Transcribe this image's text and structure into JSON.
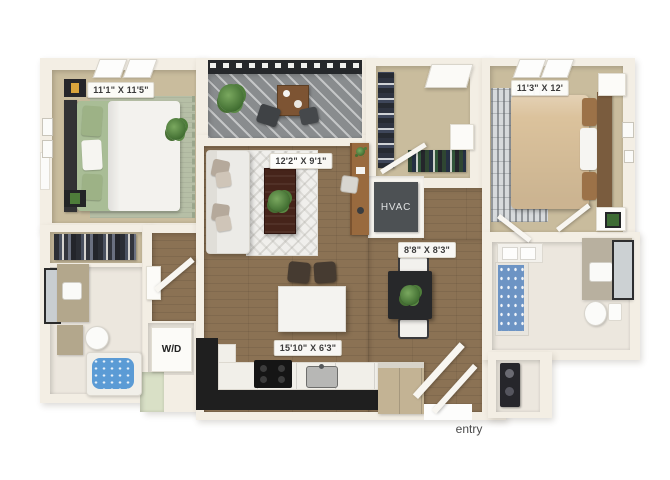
{
  "image_type": "3d-apartment-floor-plan-render",
  "labels": {
    "bedroom_left": "11'1\" X 11'5\"",
    "living_room": "12'2\" X 9'1\"",
    "bedroom_right": "11'3\" X 12'",
    "dining_area": "8'8\" X 8'3\"",
    "kitchen": "15'10\" X 6'3\"",
    "hvac": "HVAC",
    "washer_dryer": "W/D",
    "entry": "entry"
  },
  "colors": {
    "background": "#ffffff",
    "wall": "#f3eee4",
    "carpet": "#c9bc9d",
    "wood_floor": "#8b7254",
    "bath_tile": "#ece7de",
    "balcony_deck": "#898c8e",
    "railing_dark": "#26282b",
    "hvac_box": "#4d5154",
    "kitchen_counter_black": "#1f1f1f",
    "cabinet_tan": "#c3b394",
    "bed_green": "#a9bd96",
    "bed_tan": "#dbc29c",
    "tub_water_blue": "#5b9bd5",
    "shower_curtain_blue": "#6d94c4",
    "plant_green": "#4e7d3a",
    "label_text": "#3a3a3a"
  }
}
